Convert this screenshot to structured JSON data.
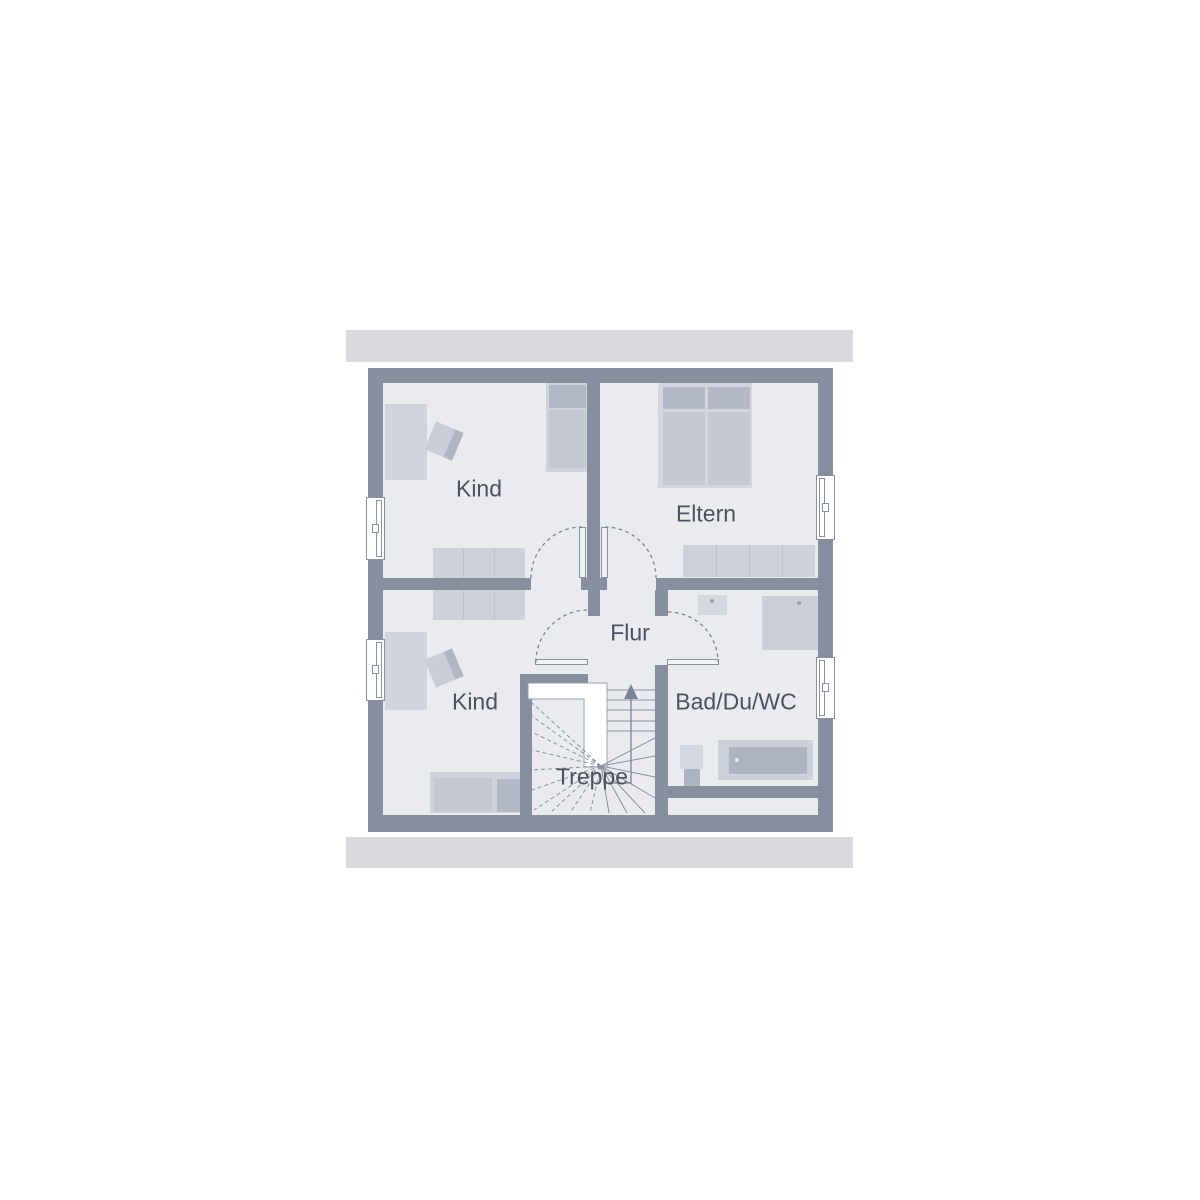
{
  "title": "Floor plan – upper storey",
  "rooms": {
    "kind_top": "Kind",
    "eltern": "Eltern",
    "flur": "Flur",
    "kind_bottom": "Kind",
    "bad": "Bad/Du/WC",
    "treppe": "Treppe"
  },
  "colors": {
    "background": "#ffffff",
    "wall": "#878f9e",
    "floor": "#e9ebef",
    "roof_overhang": "#d8dade",
    "furniture_light": "#cdd1d9",
    "furniture_medium": "#c3c8d1",
    "furniture_dark": "#b2b8c4",
    "fixture_dark": "#aeb4bf",
    "window_frame": "#ffffff",
    "door_swing": "#7b8494",
    "stair_void": "#ffffff",
    "label_text": "#4a5260"
  }
}
